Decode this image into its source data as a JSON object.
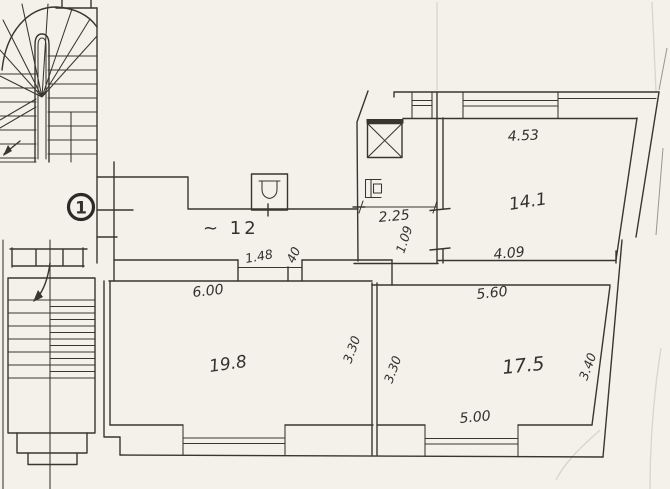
{
  "document_type": "scanned hand-drawn floor plan",
  "palette": {
    "paper": "#f3f1ea",
    "ink": "#39362f"
  },
  "marker": {
    "label": "1"
  },
  "corridor": {
    "area_label": "~ 12",
    "dims": {
      "door_width": "1.48",
      "pier_width": "40",
      "lobby_width": "2.25",
      "door_opening": "1.09"
    }
  },
  "rooms": {
    "top_right": {
      "area": "14.1",
      "dims": {
        "top": "4.53",
        "bottom": "4.09"
      }
    },
    "bottom_left": {
      "area": "19.8",
      "dims": {
        "top": "6.00",
        "right": "3.30"
      }
    },
    "bottom_right": {
      "area": "17.5",
      "dims": {
        "top": "5.60",
        "bottom": "5.00",
        "left": "3.30",
        "right": "3.40"
      }
    }
  }
}
